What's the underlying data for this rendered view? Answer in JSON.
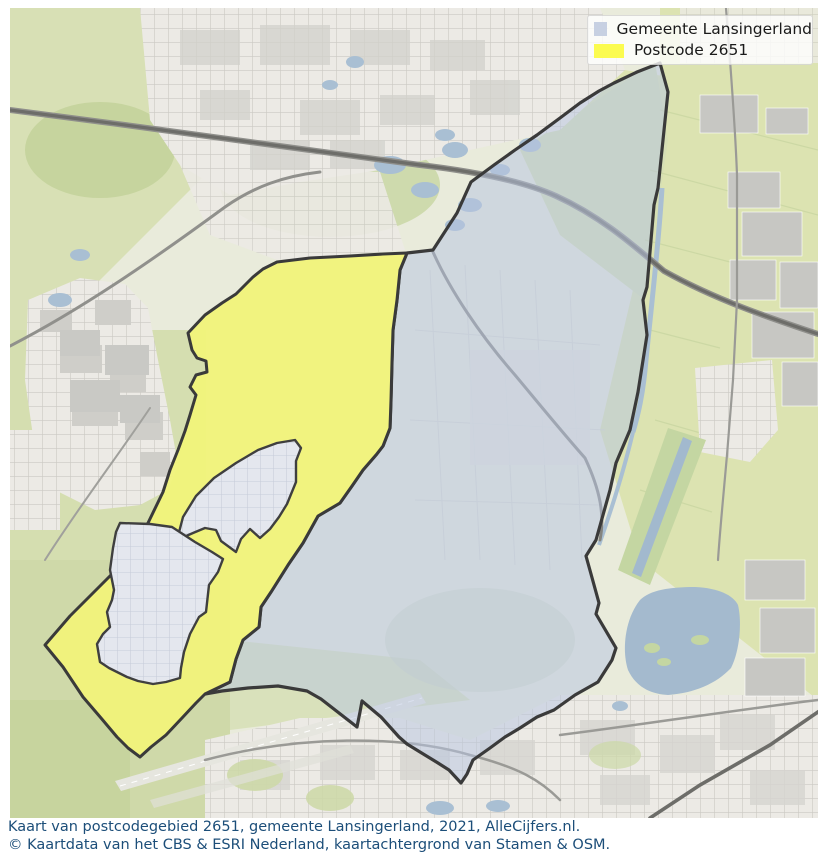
{
  "legend": {
    "items": [
      {
        "label": "Gemeente Lansingerland",
        "color": "#c7d0e2"
      },
      {
        "label": "Postcode 2651",
        "color": "#fbfb4f"
      }
    ]
  },
  "caption": {
    "line1": "Kaart van postcodegebied 2651, gemeente Lansingerland, 2021, AlleCijfers.nl.",
    "line2": "© Kaartdata van het CBS & ESRI Nederland, kaartachtergrond van Stamen & OSM.",
    "text_color": "#1c4e79"
  },
  "map": {
    "year": "2021",
    "regions": [
      {
        "name": "Gemeente Lansingerland",
        "fill": "#b8c5e0",
        "fill_opacity": "0.52",
        "stroke": "#3a3a3a"
      },
      {
        "name": "Postcode 2651",
        "fill": "#f1f37a",
        "fill_opacity": "0.95",
        "stroke": "#3a3a3a"
      },
      {
        "name": "Urban enclave north (inside postcode)",
        "fill": "#e4e7ee",
        "stroke": "#3f3f3f"
      },
      {
        "name": "Urban enclave south (inside postcode)",
        "fill": "#e4e7ee",
        "stroke": "#3f3f3f"
      }
    ],
    "background_colors": {
      "base": "#e9ebdb",
      "fields_green": "#d8e0b5",
      "forest_green": "#c6d49e",
      "urban_light": "#eceae5",
      "urban_block": "#cfcec9",
      "greenhouse_gray": "#c7c7c3",
      "water_blue": "#a4bace",
      "road_dark": "#6d6d69",
      "road_gray": "#9a9a96"
    }
  }
}
